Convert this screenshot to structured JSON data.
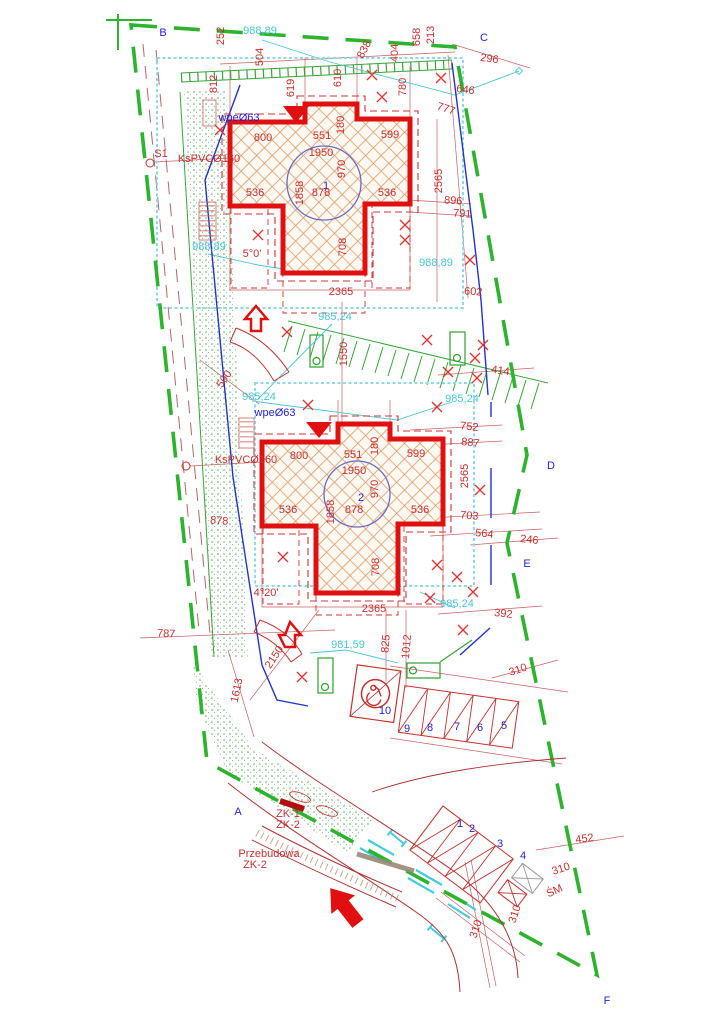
{
  "drawing": {
    "type": "site-development-plan",
    "sheet": {
      "width": 724,
      "height": 1024
    }
  },
  "colors": {
    "boundary_green": "#2db32d",
    "vegetation_green": "#3aa33a",
    "building_red": "#e01010",
    "dimension_red": "#c43030",
    "annotation_blue": "#1f1fd0",
    "utility_cyan": "#49c3d6",
    "utility_blue": "#2233cc",
    "hatch_tan": "#d79a6c"
  },
  "labels": {
    "letters": [
      {
        "t": "B",
        "x": 163,
        "y": 36,
        "s": 27,
        "c": "b"
      },
      {
        "t": "C",
        "x": 484,
        "y": 41,
        "s": 27,
        "c": "b"
      },
      {
        "t": "D",
        "x": 551,
        "y": 469,
        "s": 27,
        "c": "b"
      },
      {
        "t": "E",
        "x": 527,
        "y": 567,
        "s": 27,
        "c": "b"
      },
      {
        "t": "A",
        "x": 238,
        "y": 815,
        "s": 27,
        "c": "b"
      },
      {
        "t": "F",
        "x": 607,
        "y": 1004,
        "s": 27,
        "c": "b"
      }
    ],
    "site_dimensions": [
      {
        "t": "252",
        "x": 224,
        "y": 36,
        "r": -90
      },
      {
        "t": "504",
        "x": 263,
        "y": 57,
        "r": -90
      },
      {
        "t": "812",
        "x": 217,
        "y": 84,
        "r": -90
      },
      {
        "t": "619",
        "x": 294,
        "y": 88,
        "r": -90
      },
      {
        "t": "610",
        "x": 341,
        "y": 78,
        "r": -90
      },
      {
        "t": "838",
        "x": 367,
        "y": 51,
        "r": -62
      },
      {
        "t": "404",
        "x": 398,
        "y": 53,
        "r": -90
      },
      {
        "t": "780",
        "x": 406,
        "y": 87,
        "r": -90
      },
      {
        "t": "658",
        "x": 420,
        "y": 37,
        "r": -90
      },
      {
        "t": "213",
        "x": 434,
        "y": 35,
        "r": -90
      },
      {
        "t": "296",
        "x": 489,
        "y": 62,
        "r": 8
      },
      {
        "t": "646",
        "x": 465,
        "y": 93,
        "r": 8
      },
      {
        "t": "777",
        "x": 445,
        "y": 112,
        "r": 18
      },
      {
        "t": "2565",
        "x": 442,
        "y": 181,
        "r": -90
      },
      {
        "t": "896",
        "x": 453,
        "y": 204,
        "r": 4
      },
      {
        "t": "791",
        "x": 462,
        "y": 217,
        "r": 4
      },
      {
        "t": "602",
        "x": 473,
        "y": 295,
        "r": 4
      },
      {
        "t": "500",
        "x": 227,
        "y": 381,
        "r": -55
      },
      {
        "t": "1550",
        "x": 347,
        "y": 354,
        "r": -90
      },
      {
        "t": "414",
        "x": 500,
        "y": 374,
        "r": 8
      },
      {
        "t": "752",
        "x": 469,
        "y": 430,
        "r": 6
      },
      {
        "t": "887",
        "x": 470,
        "y": 446,
        "r": 6
      },
      {
        "t": "2565",
        "x": 468,
        "y": 476,
        "r": -90
      },
      {
        "t": "878",
        "x": 219,
        "y": 524,
        "r": 4
      },
      {
        "t": "703",
        "x": 469,
        "y": 519,
        "r": 5
      },
      {
        "t": "564",
        "x": 484,
        "y": 537,
        "r": 6
      },
      {
        "t": "246",
        "x": 529,
        "y": 543,
        "r": 6
      },
      {
        "t": "392",
        "x": 503,
        "y": 617,
        "r": 6
      },
      {
        "t": "825",
        "x": 389,
        "y": 644,
        "r": -85
      },
      {
        "t": "1012",
        "x": 410,
        "y": 647,
        "r": -85
      },
      {
        "t": "787",
        "x": 166,
        "y": 637,
        "r": 3
      },
      {
        "t": "2150",
        "x": 277,
        "y": 659,
        "r": -57
      },
      {
        "t": "1613",
        "x": 240,
        "y": 691,
        "r": -78
      },
      {
        "t": "310",
        "x": 519,
        "y": 673,
        "r": -18
      },
      {
        "t": "452",
        "x": 585,
        "y": 842,
        "r": -8
      },
      {
        "t": "310",
        "x": 562,
        "y": 872,
        "r": -18
      },
      {
        "t": "310",
        "x": 518,
        "y": 915,
        "r": -72
      },
      {
        "t": "310",
        "x": 479,
        "y": 930,
        "r": -72
      }
    ],
    "building1": [
      {
        "t": "1",
        "x": 326,
        "y": 189,
        "s": 24,
        "c": "b"
      },
      {
        "t": "800",
        "x": 263,
        "y": 141,
        "s": 13
      },
      {
        "t": "551",
        "x": 322,
        "y": 139,
        "s": 13
      },
      {
        "t": "599",
        "x": 390,
        "y": 138,
        "s": 13
      },
      {
        "t": "180",
        "x": 344,
        "y": 125,
        "r": -90,
        "s": 13
      },
      {
        "t": "1950",
        "x": 321,
        "y": 156,
        "s": 13
      },
      {
        "t": "970",
        "x": 345,
        "y": 169,
        "r": -90,
        "s": 13
      },
      {
        "t": "1858",
        "x": 303,
        "y": 193,
        "r": -90,
        "s": 13
      },
      {
        "t": "878",
        "x": 321,
        "y": 196,
        "s": 13
      },
      {
        "t": "536",
        "x": 255,
        "y": 196,
        "s": 13
      },
      {
        "t": "536",
        "x": 387,
        "y": 196,
        "s": 13
      },
      {
        "t": "708",
        "x": 346,
        "y": 247,
        "r": -90,
        "s": 13
      },
      {
        "t": "2365",
        "x": 341,
        "y": 295,
        "s": 13
      }
    ],
    "building2": [
      {
        "t": "2",
        "x": 361,
        "y": 501,
        "s": 24,
        "c": "b"
      },
      {
        "t": "800",
        "x": 299,
        "y": 459,
        "s": 13
      },
      {
        "t": "551",
        "x": 353,
        "y": 458,
        "s": 13
      },
      {
        "t": "599",
        "x": 416,
        "y": 457,
        "s": 13
      },
      {
        "t": "180",
        "x": 378,
        "y": 446,
        "r": -90,
        "s": 13
      },
      {
        "t": "1950",
        "x": 354,
        "y": 474,
        "s": 13
      },
      {
        "t": "970",
        "x": 378,
        "y": 489,
        "r": -90,
        "s": 13
      },
      {
        "t": "1858",
        "x": 334,
        "y": 512,
        "r": -90,
        "s": 13
      },
      {
        "t": "878",
        "x": 354,
        "y": 513,
        "s": 13
      },
      {
        "t": "536",
        "x": 288,
        "y": 513,
        "s": 13
      },
      {
        "t": "536",
        "x": 420,
        "y": 513,
        "s": 13
      },
      {
        "t": "708",
        "x": 379,
        "y": 567,
        "r": -90,
        "s": 13
      },
      {
        "t": "2365",
        "x": 374,
        "y": 612,
        "s": 13
      }
    ],
    "slope_angles": [
      {
        "t": "5°0'",
        "x": 252,
        "y": 257,
        "s": 14
      },
      {
        "t": "4°20'",
        "x": 266,
        "y": 596,
        "s": 14
      }
    ],
    "elevations": [
      {
        "t": "988,89",
        "x": 260,
        "y": 34,
        "s": 9.5,
        "c": "c"
      },
      {
        "t": "988,89",
        "x": 209,
        "y": 250,
        "s": 9.5,
        "c": "c"
      },
      {
        "t": "988,89",
        "x": 436,
        "y": 266,
        "s": 9.5,
        "c": "c"
      },
      {
        "t": "985,24",
        "x": 335,
        "y": 320,
        "s": 9.5,
        "c": "c"
      },
      {
        "t": "985,24",
        "x": 259,
        "y": 400,
        "s": 9.5,
        "c": "c"
      },
      {
        "t": "985,24",
        "x": 462,
        "y": 402,
        "s": 9.5,
        "c": "c"
      },
      {
        "t": "985,24",
        "x": 457,
        "y": 607,
        "s": 9.5,
        "c": "c"
      },
      {
        "t": "981,59",
        "x": 348,
        "y": 648,
        "s": 9.5,
        "c": "c"
      }
    ],
    "utilities": [
      {
        "t": "wpeØ63",
        "x": 239,
        "y": 121,
        "s": 11,
        "c": "b"
      },
      {
        "t": "wpeØ63",
        "x": 275,
        "y": 416,
        "s": 11,
        "c": "b"
      },
      {
        "t": "KsPVCØ160",
        "x": 209,
        "y": 162,
        "s": 8
      },
      {
        "t": "KsPVCØ160",
        "x": 246,
        "y": 463,
        "s": 8
      },
      {
        "t": "S1",
        "x": 161,
        "y": 157,
        "s": 8
      }
    ],
    "parking_row1": [
      {
        "t": "10",
        "x": 385,
        "y": 714,
        "s": 10,
        "c": "b"
      },
      {
        "t": "9",
        "x": 407,
        "y": 732,
        "s": 10,
        "c": "b"
      },
      {
        "t": "8",
        "x": 430,
        "y": 731,
        "s": 10,
        "c": "b"
      },
      {
        "t": "7",
        "x": 457,
        "y": 730,
        "s": 10,
        "c": "b"
      },
      {
        "t": "6",
        "x": 480,
        "y": 731,
        "s": 10,
        "c": "b"
      },
      {
        "t": "5",
        "x": 504,
        "y": 729,
        "s": 10,
        "c": "b"
      }
    ],
    "parking_row2": [
      {
        "t": "1",
        "x": 460,
        "y": 827,
        "s": 9,
        "c": "b"
      },
      {
        "t": "2",
        "x": 472,
        "y": 832,
        "s": 9,
        "c": "b"
      },
      {
        "t": "3",
        "x": 500,
        "y": 847,
        "s": 9,
        "c": "b"
      },
      {
        "t": "4",
        "x": 523,
        "y": 859,
        "s": 9,
        "c": "b"
      }
    ],
    "waste": [
      {
        "t": "ŚM",
        "x": 556,
        "y": 894,
        "r": -25,
        "s": 12
      }
    ],
    "annotations": [
      {
        "t": "ZK-1",
        "x": 288,
        "y": 817,
        "s": 9.5
      },
      {
        "t": "ZK-2",
        "x": 288,
        "y": 828,
        "s": 9.5
      },
      {
        "t": "Przebudowa",
        "x": 269,
        "y": 857,
        "s": 9.5
      },
      {
        "t": "ZK-2",
        "x": 255,
        "y": 868,
        "s": 9.5
      }
    ]
  }
}
